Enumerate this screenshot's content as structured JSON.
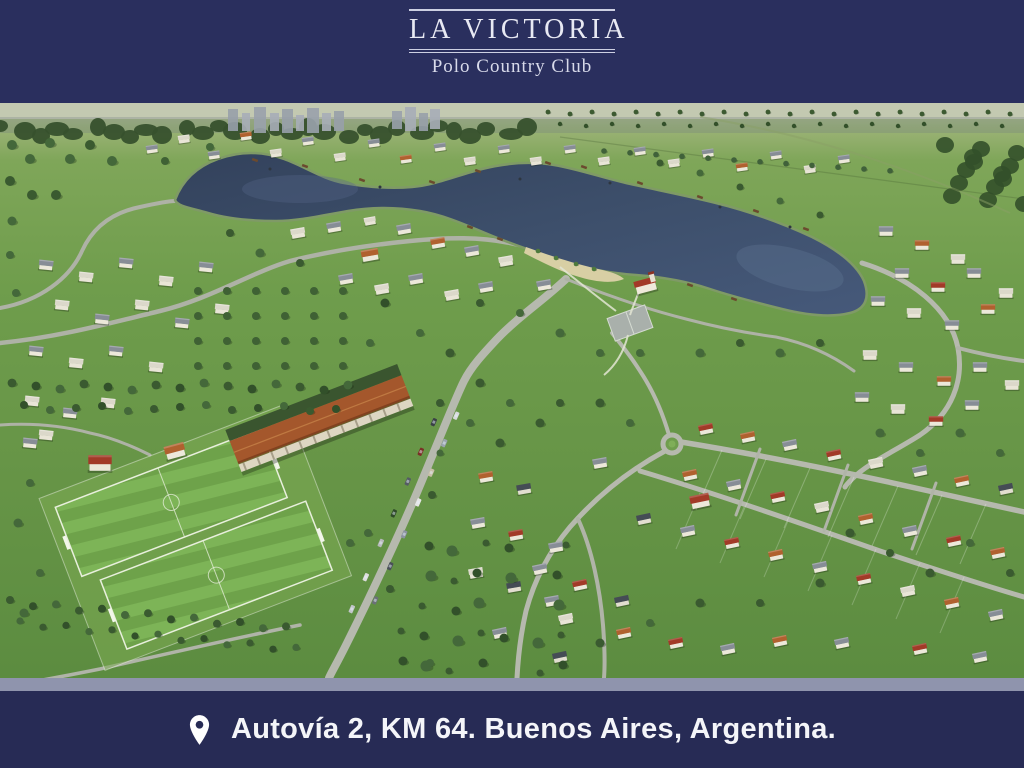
{
  "brand": {
    "title": "LA VICTORIA",
    "subtitle": "Polo Country Club"
  },
  "footer": {
    "address": "Autovía 2, KM 64. Buenos Aires, Argentina."
  },
  "icons": {
    "location_pin": "location-pin-icon"
  },
  "colors": {
    "navy": "#2a2f5e",
    "footer_navy": "#272b55",
    "separator": "#8f94ad",
    "logo_text": "#e8e9f3",
    "subtitle_text": "#d8daea",
    "address_text": "#f4f5f9",
    "lake": "#3c4f6a",
    "grass": "#6f9d4d",
    "field_stripe_light": "#7db457",
    "field_stripe_dark": "#6ea24a",
    "stable_roof": "#a4572c",
    "road": "#b6b9ae"
  }
}
